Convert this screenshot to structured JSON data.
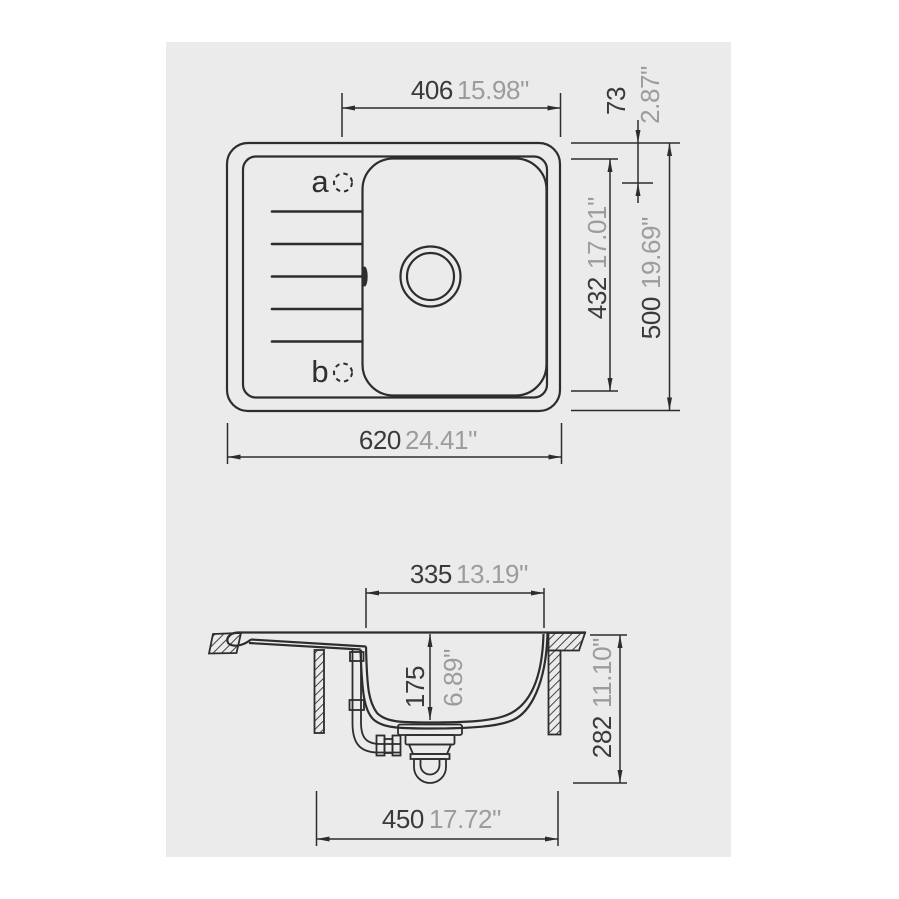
{
  "colors": {
    "page_background": "#ffffff",
    "canvas_background": "#ebebeb",
    "line": "#2d2d2d",
    "metric_text": "#3a3a3a",
    "inch_text": "#9c9c9c"
  },
  "top_view": {
    "tap_holes": {
      "a": "a",
      "b": "b"
    },
    "dimensions": {
      "bowl_width": {
        "metric": "406",
        "inch": "15.98\""
      },
      "top_offset": {
        "metric": "73",
        "inch": "2.87\""
      },
      "inner_length": {
        "metric": "432",
        "inch": "17.01\""
      },
      "overall_length": {
        "metric": "500",
        "inch": "19.69\""
      },
      "overall_width": {
        "metric": "620",
        "inch": "24.41\""
      }
    }
  },
  "section_view": {
    "dimensions": {
      "bowl_top_width": {
        "metric": "335",
        "inch": "13.19\""
      },
      "bowl_depth": {
        "metric": "175",
        "inch": "6.89\""
      },
      "overall_height": {
        "metric": "282",
        "inch": "11.10\""
      },
      "cabinet_width": {
        "metric": "450",
        "inch": "17.72\""
      }
    }
  }
}
